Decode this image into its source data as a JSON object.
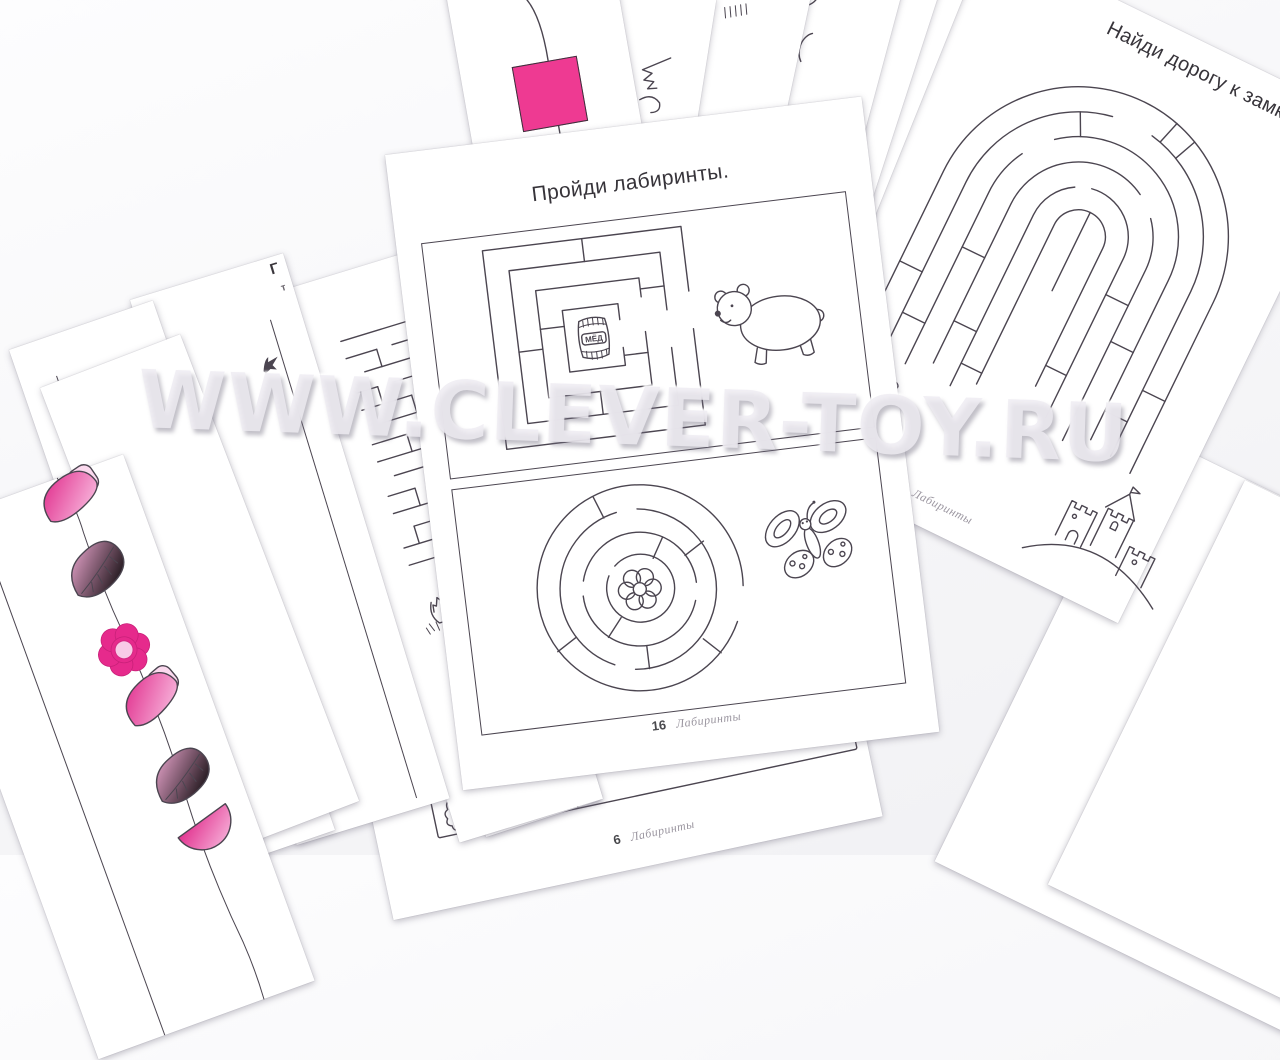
{
  "watermark": {
    "text": "WWW.CLEVER-TOY.RU"
  },
  "colors": {
    "accent_magenta": "#ee3a92",
    "flower_magenta": "#e62a8c",
    "pink_light": "#fbd9ee",
    "line_ink": "#4b4550",
    "footer_gray": "#9b96a0"
  },
  "pages": {
    "center_worksheet": {
      "title": "Пройди лабиринты.",
      "barrel_label": "МЁД",
      "page_number": "16",
      "series_label": "Лабиринты"
    },
    "right_worksheet": {
      "title": "Найди дорогу к замку.",
      "page_number": "15",
      "series_label": "Лабиринты"
    },
    "bottom_worksheet": {
      "page_number": "6",
      "series_label": "Лабиринты"
    },
    "left_worksheet_fragment": {
      "visible_letter": "Г",
      "visible_letter_secondary": "т"
    }
  }
}
